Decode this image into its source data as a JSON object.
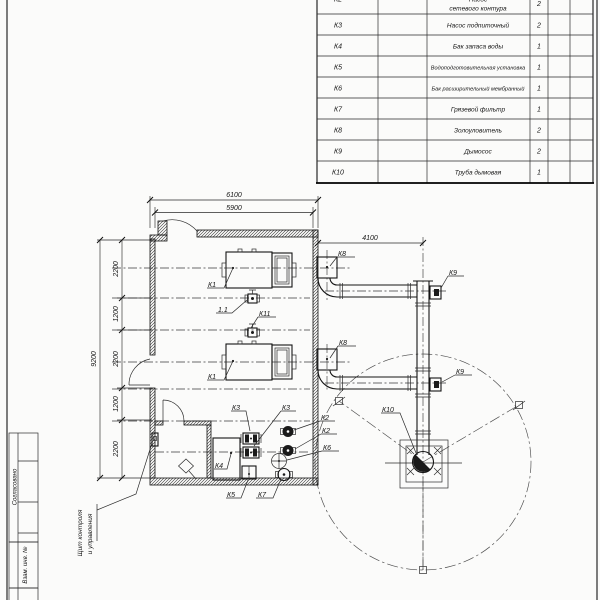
{
  "sheet": {
    "side_labels": {
      "approved": "Согласовано",
      "replace_inv": "Взам. инв. №"
    }
  },
  "spec_table": {
    "rows": [
      {
        "pos": "К2",
        "name": "Насос сетевого контура",
        "name_line1": "Насос",
        "name_line2": "сетевого контура",
        "qty": "2"
      },
      {
        "pos": "К3",
        "name": "Насос подпиточный",
        "qty": "2"
      },
      {
        "pos": "К4",
        "name": "Бак запаса воды",
        "qty": "1"
      },
      {
        "pos": "К5",
        "name": "Водоподготовительная установка",
        "qty": "1"
      },
      {
        "pos": "К6",
        "name": "Бак расширительный мембранный",
        "qty": "1"
      },
      {
        "pos": "К7",
        "name": "Грязевой фильтр",
        "qty": "1"
      },
      {
        "pos": "К8",
        "name": "Золоуловитель",
        "qty": "2"
      },
      {
        "pos": "К9",
        "name": "Дымосос",
        "qty": "2"
      },
      {
        "pos": "К10",
        "name": "Труба дымовая",
        "qty": "1"
      }
    ]
  },
  "plan": {
    "dimensions": {
      "outer_width": "6100",
      "inner_width": "5900",
      "chimney_offset": "4100",
      "overall_depth": "9200",
      "row_spacings": [
        "2200",
        "1200",
        "2200",
        "1200",
        "2200"
      ]
    },
    "labels": {
      "boiler_1": "К1",
      "boiler_2": "К1",
      "valve_11": "1.1",
      "valve_k11": "К11",
      "ash_collector_1": "К8",
      "ash_collector_2": "К8",
      "smoke_exhauster_1": "К9",
      "smoke_exhauster_2": "К9",
      "chimney": "К10",
      "feed_pump_1": "К3",
      "feed_pump_2": "К3",
      "network_pump_1": "К2",
      "network_pump_2": "К2",
      "expansion_tank": "К6",
      "water_tank": "К4",
      "water_treatment": "К5",
      "mud_filter": "К7"
    },
    "annotations": {
      "control_panel_line1": "Щит контроля",
      "control_panel_line2": "и управления"
    }
  }
}
